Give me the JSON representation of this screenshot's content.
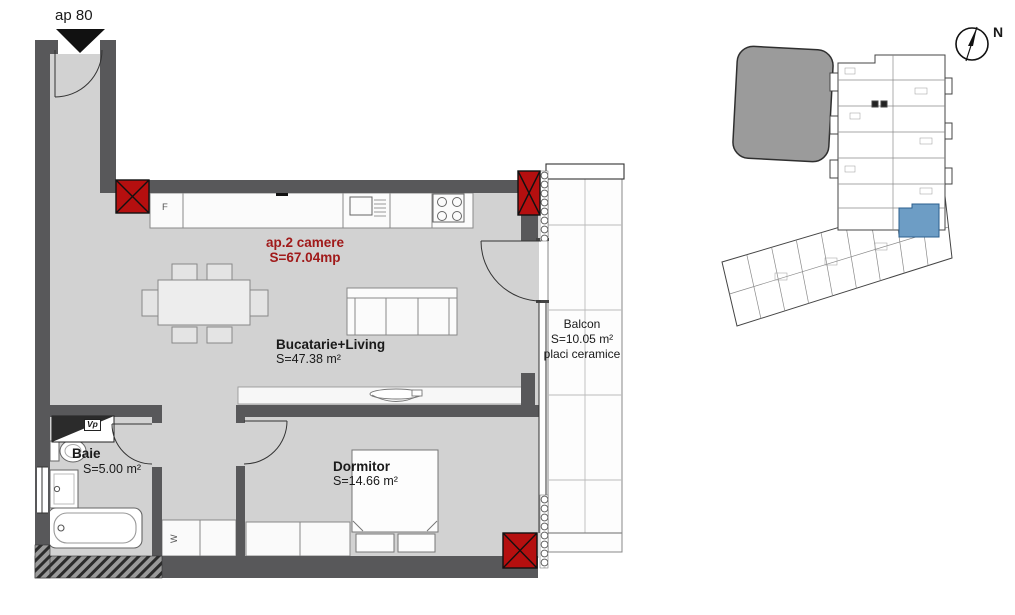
{
  "plan": {
    "entrance_label": "ap 80",
    "apartment": {
      "name": "ap.2 camere",
      "area": "S=67.04mp"
    },
    "rooms": [
      {
        "name": "Bucatarie+Living",
        "area": "S=47.38 m²"
      },
      {
        "name": "Dormitor",
        "area": "S=14.66 m²"
      },
      {
        "name": "Baie",
        "area": "S=5.00 m²"
      },
      {
        "name": "Balcon",
        "area": "S=10.05 m²",
        "finish": "placi ceramice"
      }
    ],
    "markers": {
      "fridge": "F",
      "ventilation": "Vp",
      "wardrobe": "W"
    }
  },
  "site_plan": {
    "north": "N"
  },
  "colors": {
    "floor": "#d2d2d2",
    "wall": "#58585a",
    "column_red": "#b50f0f",
    "accent_text_red": "#a01a1a",
    "highlight_unit_blue": "#6d9dc5",
    "site_building_gray": "#9b9b9b"
  }
}
